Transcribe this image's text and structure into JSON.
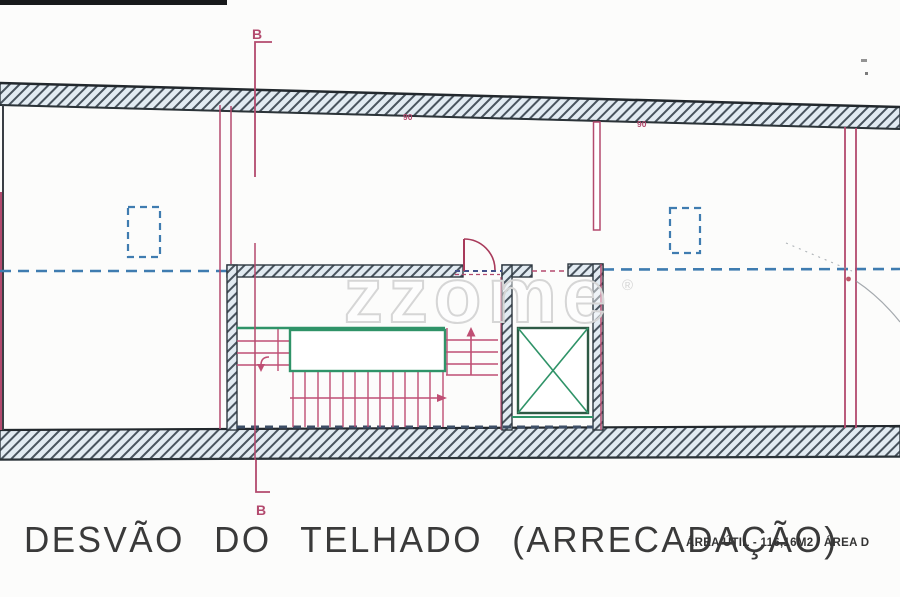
{
  "page": {
    "width": 900,
    "height": 597,
    "background": "#fcfcfb"
  },
  "title_block": {
    "title": "DESVÃO DO TELHADO (ARRECADAÇÃO)",
    "area_note": "ÁREA ÚTIL - 116,16M2 / ÁREA D"
  },
  "section_markers": {
    "top": "B",
    "bottom": "B"
  },
  "dimension_labels": {
    "left": "90",
    "right": "90"
  },
  "watermark": {
    "text": "zzome",
    "registered": "®"
  },
  "colors": {
    "line_magenta": "#b34a6e",
    "stair_magenta": "#bf4f74",
    "line_green": "#2f9368",
    "dashed_blue": "#3f7cb0",
    "hatch_stripe": "#49545e",
    "hatch_fill": "#e2ebf2",
    "ink": "#2f3a42",
    "title_ink": "#3a3a3a"
  }
}
